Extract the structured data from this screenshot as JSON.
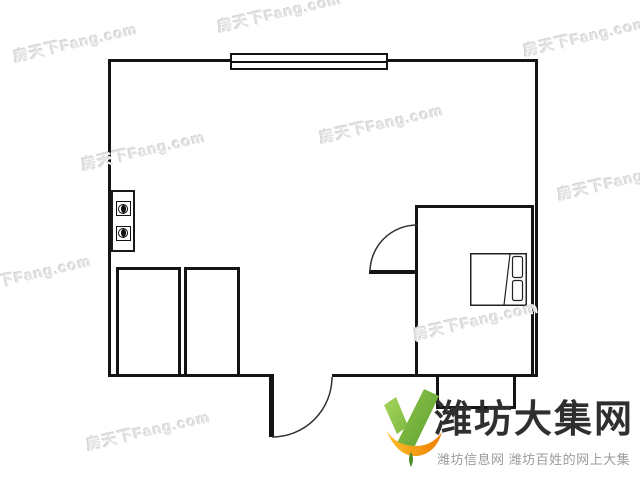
{
  "canvas": {
    "background": "#ffffff"
  },
  "colors": {
    "wall": "#141414",
    "watermark": "#e4e4e4"
  },
  "watermark": {
    "text": "房天下Fang.com"
  },
  "floorplan": {
    "rooms": [
      "main-room",
      "bedroom"
    ],
    "features": [
      "window-top-wall",
      "stove-two-burner-icon",
      "cabinet-left",
      "cabinet-right",
      "bed-with-pillows",
      "bedroom-door-swing",
      "entry-door-swing",
      "bay-balcony"
    ]
  },
  "logo": {
    "title": "潍坊大集网",
    "subtitle": "潍坊信息网 潍坊百姓的网上大集",
    "title_color": "#2f2f2f",
    "subtitle_color": "#9b9b9b",
    "check_green_light": "#9ccc52",
    "check_green_dark": "#66a832",
    "swoosh_orange_light": "#fbc02d",
    "swoosh_orange_dark": "#ef7d00"
  }
}
